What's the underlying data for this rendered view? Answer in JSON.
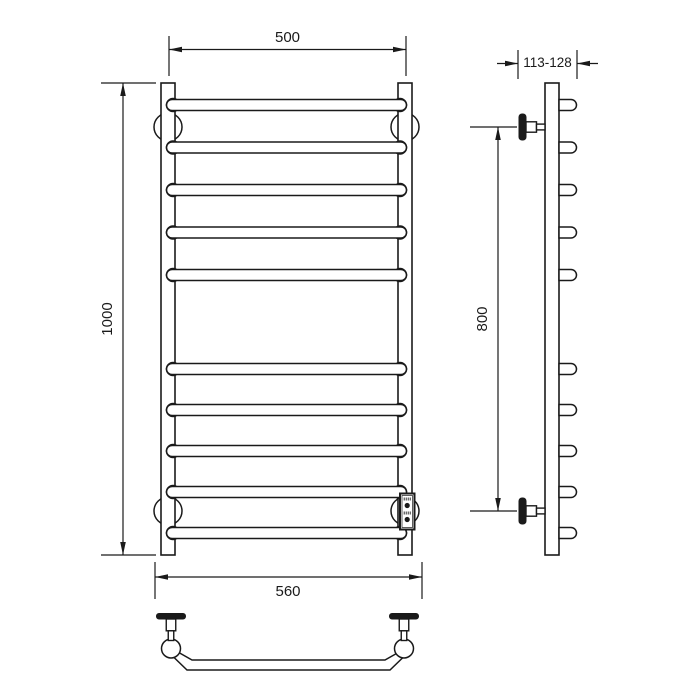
{
  "drawing": {
    "subject": "towel-rail-technical-drawing",
    "background_color": "#ffffff",
    "line_color": "#1a1a1a"
  },
  "dimensions": {
    "top_width": "500",
    "overall_height": "1000",
    "bottom_width": "560",
    "depth_range": "113-128",
    "mount_spacing": "800"
  }
}
